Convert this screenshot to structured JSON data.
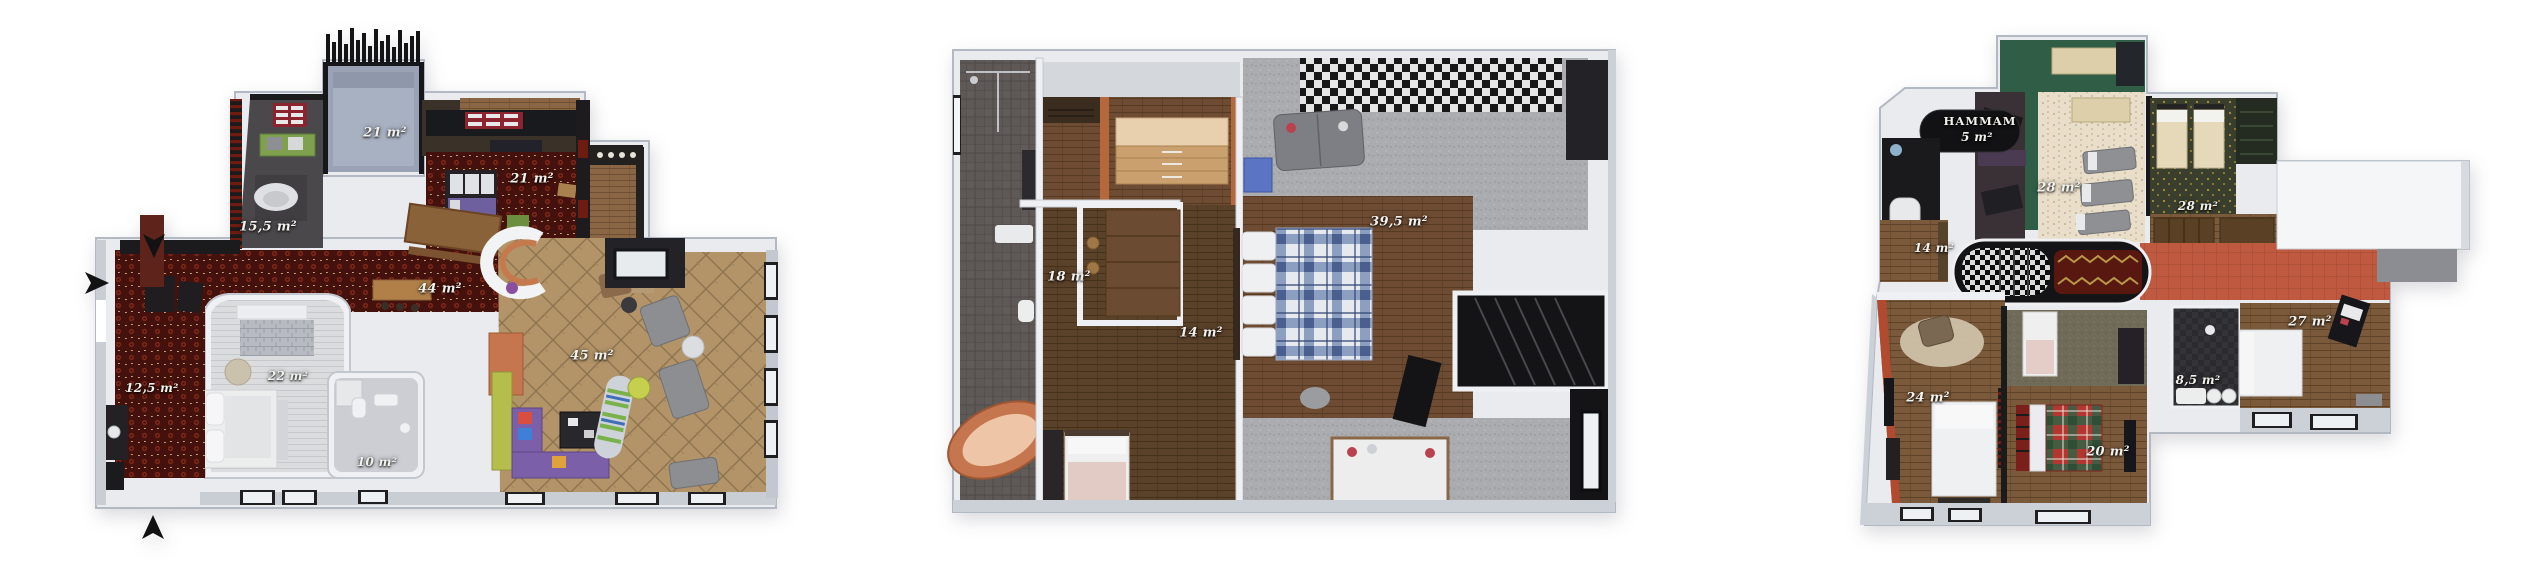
{
  "canvas": {
    "width": 2533,
    "height": 580,
    "background": "#ffffff",
    "description_visible_text_only": true
  },
  "plans": [
    {
      "name": "left-floor-plan",
      "area_labels": [
        "21 m²",
        "21 m²",
        "15,5 m²",
        "44 m²",
        "45 m²",
        "22 m²",
        "12,5 m²",
        "10 m²"
      ],
      "entrance_arrows": [
        "down",
        "right",
        "up"
      ]
    },
    {
      "name": "middle-floor-plan",
      "area_labels": [
        "39,5 m²",
        "18 m²",
        "14 m²"
      ]
    },
    {
      "name": "right-floor-plan",
      "hammam_label": "HAMMAM",
      "area_labels": [
        "5 m²",
        "28 m²",
        "28 m²",
        "14 m²",
        "27 m²",
        "8,5 m²",
        "24 m²",
        "20 m²"
      ]
    }
  ],
  "palette": {
    "red_carpet": "#45110c",
    "parquet": "#b29468",
    "wood_mid": "#6e4c33",
    "wood_dark": "#5a4129",
    "wood_plan3": "#7b5a3c",
    "grey_carpet": "#abacaf",
    "terrace_grey_blue": "#9aa3b5",
    "dark_wall": "#1b1a1d",
    "green_wall": "#2f5d46",
    "orange_wall": "#b4683c",
    "copper": "#c5764e",
    "red_tile": "#bf5a40",
    "speckle_cream": "#e8deca",
    "purple_sofa": "#7b5fa8",
    "label_text": "#f2f1ec",
    "outer_wall": "#ccd1d8",
    "inner_wall": "#eef0f3"
  }
}
